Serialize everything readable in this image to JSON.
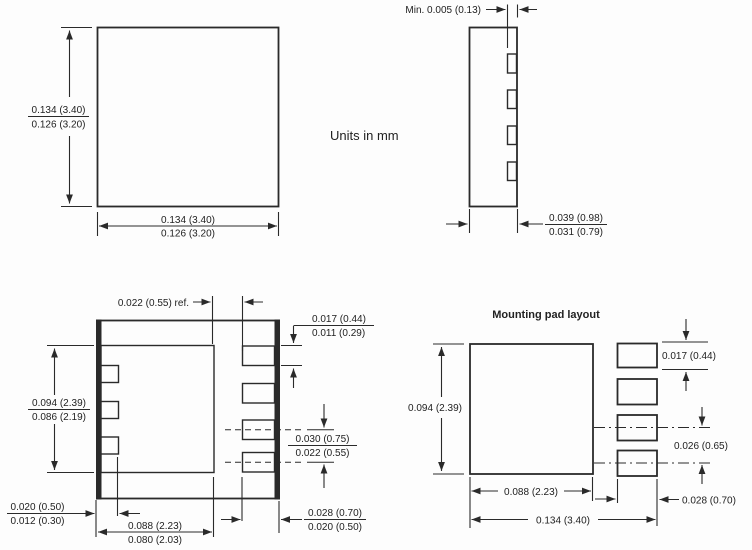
{
  "colors": {
    "line": "#2a2a2a",
    "text": "#222222",
    "background": "#fdfdfd"
  },
  "units_note": "Units in mm",
  "package_top_view": {
    "height": {
      "max": "0.134 (3.40)",
      "min": "0.126 (3.20)"
    },
    "width": {
      "max": "0.134 (3.40)",
      "min": "0.126 (3.20)"
    }
  },
  "package_side_view": {
    "terminal_offset": "Min. 0.005 (0.13)",
    "thickness": {
      "max": "0.039 (0.98)",
      "min": "0.031 (0.79)"
    }
  },
  "package_bottom_view": {
    "pad_to_terminal_gap": "0.022 (0.55) ref.",
    "terminal_width": {
      "max": "0.017 (0.44)",
      "min": "0.011 (0.29)"
    },
    "die_pad_height": {
      "max": "0.094 (2.39)",
      "min": "0.086 (2.19)"
    },
    "terminal_pitch": {
      "max": "0.030 (0.75)",
      "min": "0.022 (0.55)"
    },
    "side_terminal_length": {
      "max": "0.020 (0.50)",
      "min": "0.012 (0.30)"
    },
    "die_pad_width": {
      "max": "0.088 (2.23)",
      "min": "0.080 (2.03)"
    },
    "terminal_length": {
      "max": "0.028 (0.70)",
      "min": "0.020 (0.50)"
    }
  },
  "mounting_pad_layout": {
    "title": "Mounting pad layout",
    "center_pad_height": "0.094 (2.39)",
    "terminal_pad_width": "0.017 (0.44)",
    "terminal_pad_pitch": "0.026 (0.65)",
    "center_pad_width": "0.088 (2.23)",
    "terminal_pad_length": "0.028 (0.70)",
    "overall_width": "0.134 (3.40)"
  }
}
